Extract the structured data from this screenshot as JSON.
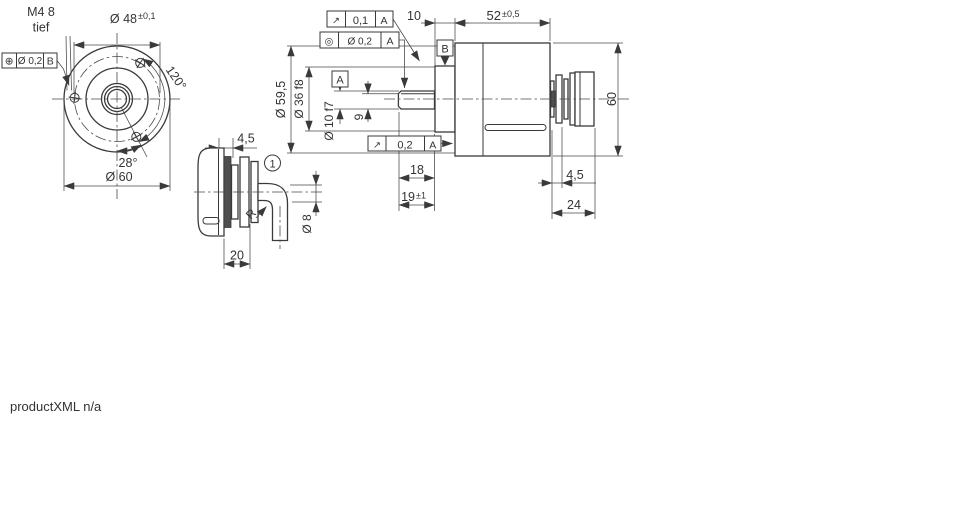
{
  "watermark": "productXML n/a",
  "front_view": {
    "thread_callout": {
      "line1": "M4 8",
      "line2": "tief"
    },
    "dim_bolt_circle": {
      "value": "Ø 48",
      "tolerance": "±0,1"
    },
    "position_frame": {
      "symbol": "⊕",
      "value": "Ø 0,2",
      "datum": "B"
    },
    "angle_bolts": "120°",
    "angle_screw": "28°",
    "dim_outer": "Ø 60"
  },
  "cable_view": {
    "dim_clamp": "4,5",
    "dim_length": "20",
    "bend_radius": "R",
    "dim_cable": "Ø 8",
    "note_marker": "1"
  },
  "side_view": {
    "frame_runout_shaft": {
      "symbol": "↗",
      "value": "0,1",
      "datum": "A"
    },
    "frame_concentricity": {
      "symbol": "◎",
      "value": "Ø 0,2",
      "datum": "A"
    },
    "frame_runout_face": {
      "symbol": "↗",
      "value": "0,2",
      "datum": "A"
    },
    "datum_a": "A",
    "datum_b": "B",
    "dim_flange": "10",
    "dim_body": {
      "value": "52",
      "tolerance": "±0,5"
    },
    "dim_height": "60",
    "dia_body": "Ø 59,5",
    "dia_pilot": "Ø 36 f8",
    "dia_shaft": "Ø 10 f7",
    "dim_flat": "9",
    "dim_shaft_len": "18",
    "dim_shaft_len2": {
      "value": "19",
      "tolerance": "±1"
    },
    "dim_connector_rings": "4,5",
    "dim_connector": "24"
  }
}
